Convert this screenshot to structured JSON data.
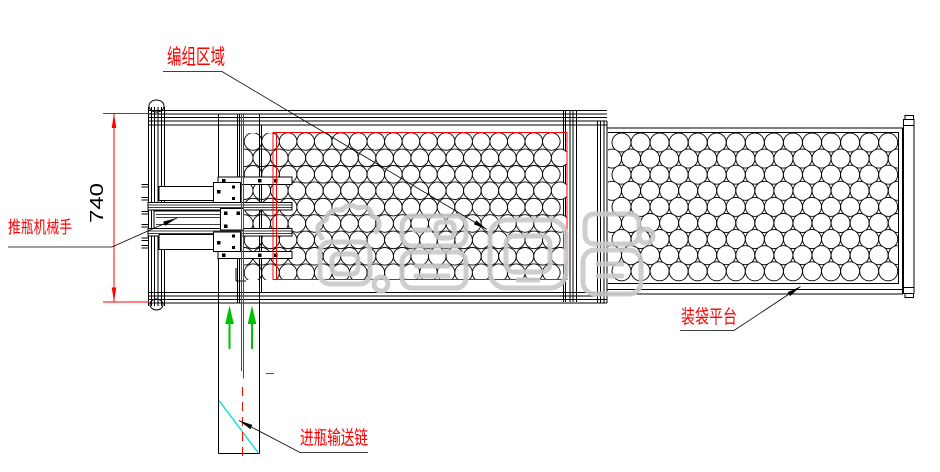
{
  "drawing": {
    "type": "cad-machine-layout",
    "annotations": {
      "grouping_area": {
        "label": "编组区域"
      },
      "pusher": {
        "label": "推瓶机械手"
      },
      "bagging_platform": {
        "label": "装袋平台"
      },
      "infeed_chain": {
        "label": "进瓶输送链"
      },
      "dimension_height": {
        "value": "740"
      }
    },
    "colors": {
      "line": "#000000",
      "annotation": "#ff0000",
      "flow_arrow": "#00c000",
      "aux_line": "#00dcdc",
      "watermark": "#c9c9c9",
      "background": "#ffffff"
    },
    "watermark": {
      "glyph_count": 4
    },
    "bottle_grids": [
      {
        "name": "grouping-conveyor-bottles",
        "x0": 253,
        "y0": 141.5,
        "dx": 17.55,
        "dy": 16.4,
        "cols": 18,
        "rows": 9,
        "r": 8.8,
        "clip": [
          244,
          133,
          567,
          280
        ]
      },
      {
        "name": "bagging-platform-bottles",
        "x0": 621.5,
        "y0": 142.5,
        "dx": 19.05,
        "dy": 16.1,
        "cols": 15,
        "rows": 9,
        "r": 9.5,
        "clip": [
          608,
          133,
          898.5,
          283.5
        ]
      }
    ]
  }
}
